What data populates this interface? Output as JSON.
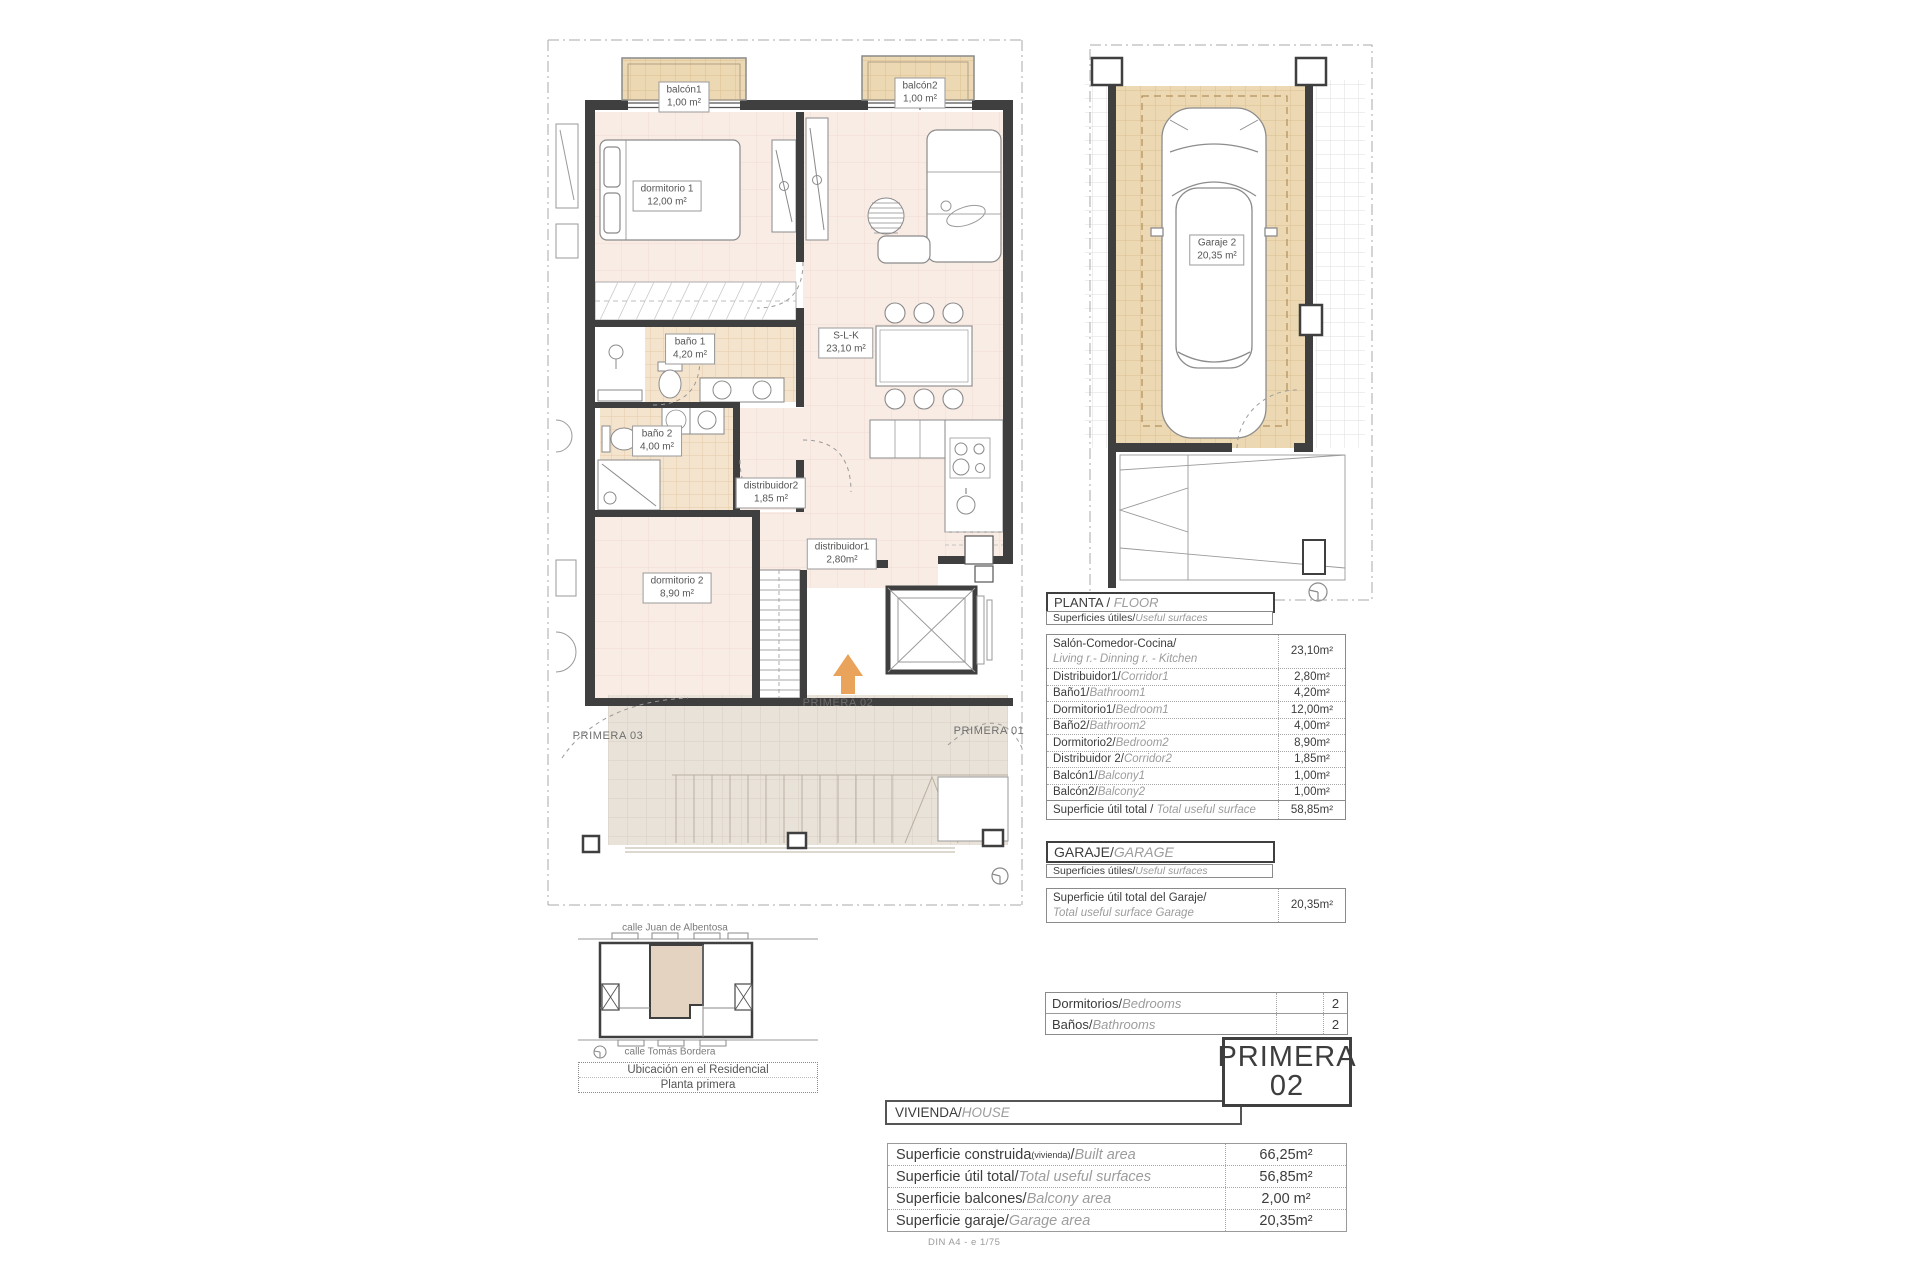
{
  "sheet": {
    "footer": "DIN A4 - e 1/75"
  },
  "colors": {
    "accent_arrow": "#e9a35b",
    "wall": "#3f3f3f",
    "floor_pink": "#f9ece5",
    "tile_tan": "#ecd8b2"
  },
  "floor_plan": {
    "rooms": [
      {
        "name": "balcón1",
        "area": "1,00 m²"
      },
      {
        "name": "balcón2",
        "area": "1,00 m²"
      },
      {
        "name": "dormitorio 1",
        "area": "12,00 m²"
      },
      {
        "name": "baño 1",
        "area": "4,20 m²"
      },
      {
        "name": "S-L-K",
        "area": "23,10 m²"
      },
      {
        "name": "baño 2",
        "area": "4,00 m²"
      },
      {
        "name": "distribuidor2",
        "area": "1,85 m²"
      },
      {
        "name": "distribuidor1",
        "area": "2,80m²"
      },
      {
        "name": "dormitorio 2",
        "area": "8,90 m²"
      }
    ],
    "unit_labels": {
      "left": "PRIMERA 03",
      "center": "PRIMERA 02",
      "right": "PRIMERA 01"
    }
  },
  "garage_plan": {
    "room": {
      "name": "Garaje 2",
      "area": "20,35 m²"
    }
  },
  "location_diagram": {
    "street_top": "calle Juan de Albentosa",
    "street_bottom": "calle Tomás Bordera",
    "caption_line1": "Ubicación en el Residencial",
    "caption_line2": "Planta primera"
  },
  "planta_table": {
    "title_es": "PLANTA / ",
    "title_en": "FLOOR",
    "subtitle_es": "Superficies útiles/",
    "subtitle_en": "Useful surfaces",
    "rows": [
      {
        "es": "Salón-Comedor-Cocina/",
        "en": "Living r.- Dinning r. - Kitchen",
        "value": "23,10m²"
      },
      {
        "es": "Distribuidor1/",
        "en": "Corridor1",
        "value": "2,80m²"
      },
      {
        "es": "Baño1/",
        "en": "Bathroom1",
        "value": "4,20m²"
      },
      {
        "es": "Dormitorio1/",
        "en": "Bedroom1",
        "value": "12,00m²"
      },
      {
        "es": "Baño2/",
        "en": "Bathroom2",
        "value": "4,00m²"
      },
      {
        "es": "Dormitorio2/",
        "en": "Bedroom2",
        "value": "8,90m²"
      },
      {
        "es": "Distribuidor 2/",
        "en": "Corridor2",
        "value": "1,85m²"
      },
      {
        "es": "Balcón1/",
        "en": "Balcony1",
        "value": "1,00m²"
      },
      {
        "es": "Balcón2/",
        "en": "Balcony2",
        "value": "1,00m²"
      }
    ],
    "total": {
      "es": "Superficie útil total / ",
      "en": "Total useful surface",
      "value": "58,85m²"
    }
  },
  "garaje_table": {
    "title_es": "GARAJE/",
    "title_en": "GARAGE",
    "subtitle_es": "Superficies útiles/",
    "subtitle_en": "Useful surfaces",
    "row": {
      "es": "Superficie útil total del Garaje/",
      "en": "Total useful surface Garage",
      "value": "20,35m²"
    }
  },
  "counts_table": {
    "rows": [
      {
        "es": "Dormitorios/",
        "en": "Bedrooms",
        "value": "2"
      },
      {
        "es": "Baños/",
        "en": "Bathrooms",
        "value": "2"
      }
    ]
  },
  "unit_badge": {
    "line1": "PRIMERA",
    "line2": "02"
  },
  "vivienda_table": {
    "title_es": "VIVIENDA/",
    "title_en": "HOUSE",
    "rows": [
      {
        "es": "Superficie construida",
        "small": "(vivienda)",
        "slash": "/",
        "en": "Built area",
        "value": "66,25m²"
      },
      {
        "es": "Superficie útil total/",
        "en": "Total useful surfaces",
        "value": "56,85m²"
      },
      {
        "es": "Superficie balcones/",
        "en": "Balcony area",
        "value": "2,00 m²"
      },
      {
        "es": "Superficie garaje/",
        "en": "Garage area",
        "value": "20,35m²"
      }
    ]
  }
}
